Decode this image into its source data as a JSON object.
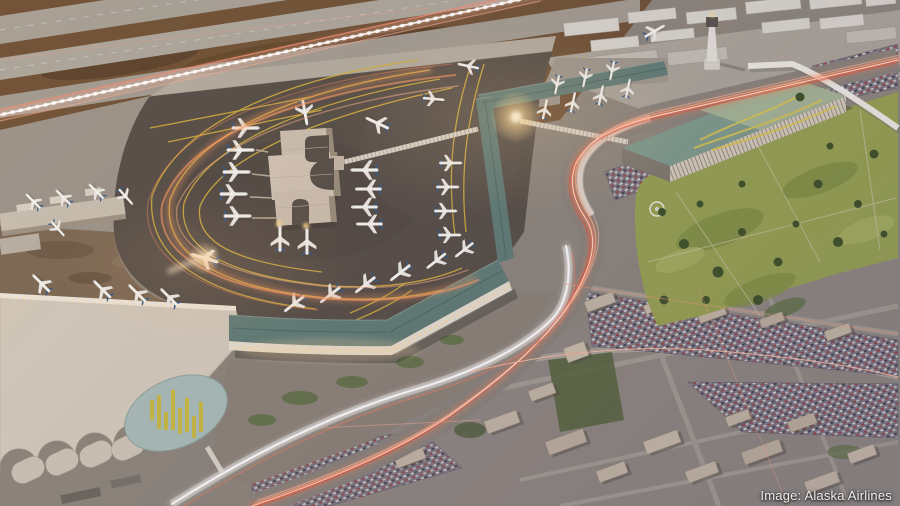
{
  "meta": {
    "type": "architectural aerial rendering",
    "subject": "Airport terminal expansion concept viewed from the air at dusk",
    "dimensions": "900x506"
  },
  "credit": {
    "label": "Image: Alaska Airlines"
  },
  "scene": {
    "landmarks": [
      "parallel runways and taxiways with time-lapse light trails",
      "new satellite concourse with courtyard cutouts and parked aircraft",
      "crescent-shaped concourse with slate-teal roof and lit gate face",
      "north gate pier with aircraft on both sides",
      "existing terminal complex with barrel-vault halls and oval green roof",
      "air traffic control tower",
      "air cargo warehouses",
      "ground transportation center with rooftop garden art",
      "elevated guideway and freeway interchange with red traffic light trails",
      "light-rail corridor with white light trail",
      "public park with trees and helipad",
      "surface parking lots full of cars",
      "surrounding city blocks with low-rise buildings"
    ],
    "aircraft_visible": 37,
    "palette": {
      "apron": "#544c45",
      "runway": "#a59f95",
      "infield_brown": "#6d4f33",
      "terminal_roof_teal": "#5e7b75",
      "building_beige": "#cdbfae",
      "gt_roof_green": "#7d9a8b",
      "roof_art_yellow": "#d2ae3c",
      "park_green": "#95a150",
      "trail_red": "#ff6a45",
      "trail_white": "#fff3e6",
      "city_gray": "#8d8680"
    }
  }
}
